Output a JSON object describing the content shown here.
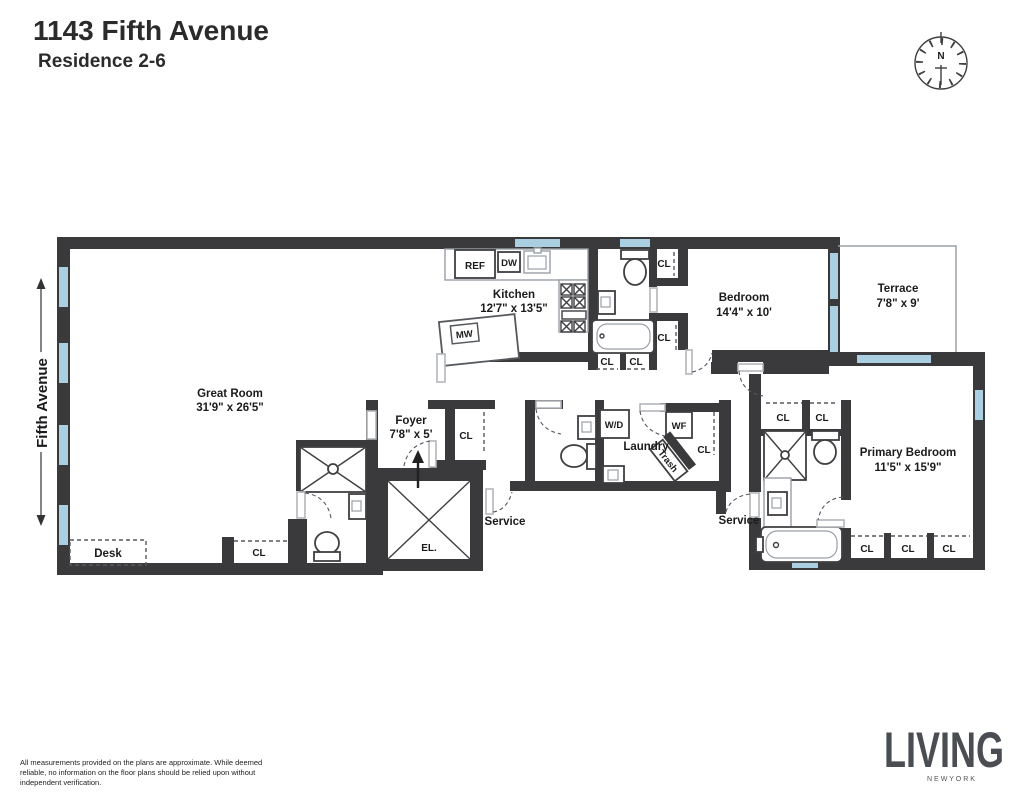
{
  "header": {
    "title": "1143 Fifth Avenue",
    "subtitle": "Residence 2-6"
  },
  "compass": {
    "north": "N"
  },
  "street": {
    "label": "Fifth Avenue"
  },
  "rooms": {
    "great_room": {
      "name": "Great Room",
      "dims": "31'9\" x 26'5\""
    },
    "kitchen": {
      "name": "Kitchen",
      "dims": "12'7\" x 13'5\""
    },
    "foyer": {
      "name": "Foyer",
      "dims": "7'8\" x 5'"
    },
    "bedroom": {
      "name": "Bedroom",
      "dims": "14'4\" x 10'"
    },
    "terrace": {
      "name": "Terrace",
      "dims": "7'8\" x 9'"
    },
    "primary_bedroom": {
      "name": "Primary Bedroom",
      "dims": "11'5\" x 15'9\""
    },
    "laundry": {
      "name": "Laundry"
    }
  },
  "fixtures": {
    "ref": "REF",
    "dw": "DW",
    "mw": "MW",
    "wd": "W/D",
    "wf": "WF",
    "trash": "Trash",
    "elevator": "EL.",
    "desk": "Desk",
    "closet": "CL",
    "service": "Service"
  },
  "footer": {
    "disclaimer_lines": [
      "All measurements provided on the plans are approximate. While deemed",
      "reliable, no information on the floor plans should be relied upon without",
      "independent verification."
    ],
    "brand": "LIVING",
    "brand_sub": "N E W   Y O R K"
  },
  "colors": {
    "wall": "#3a3a3c",
    "window": "#a9cfe0",
    "plant_light": "#8db93e",
    "plant_dark": "#4e7a1e",
    "text": "#1b1b1b",
    "brand": "#4a4d52"
  }
}
